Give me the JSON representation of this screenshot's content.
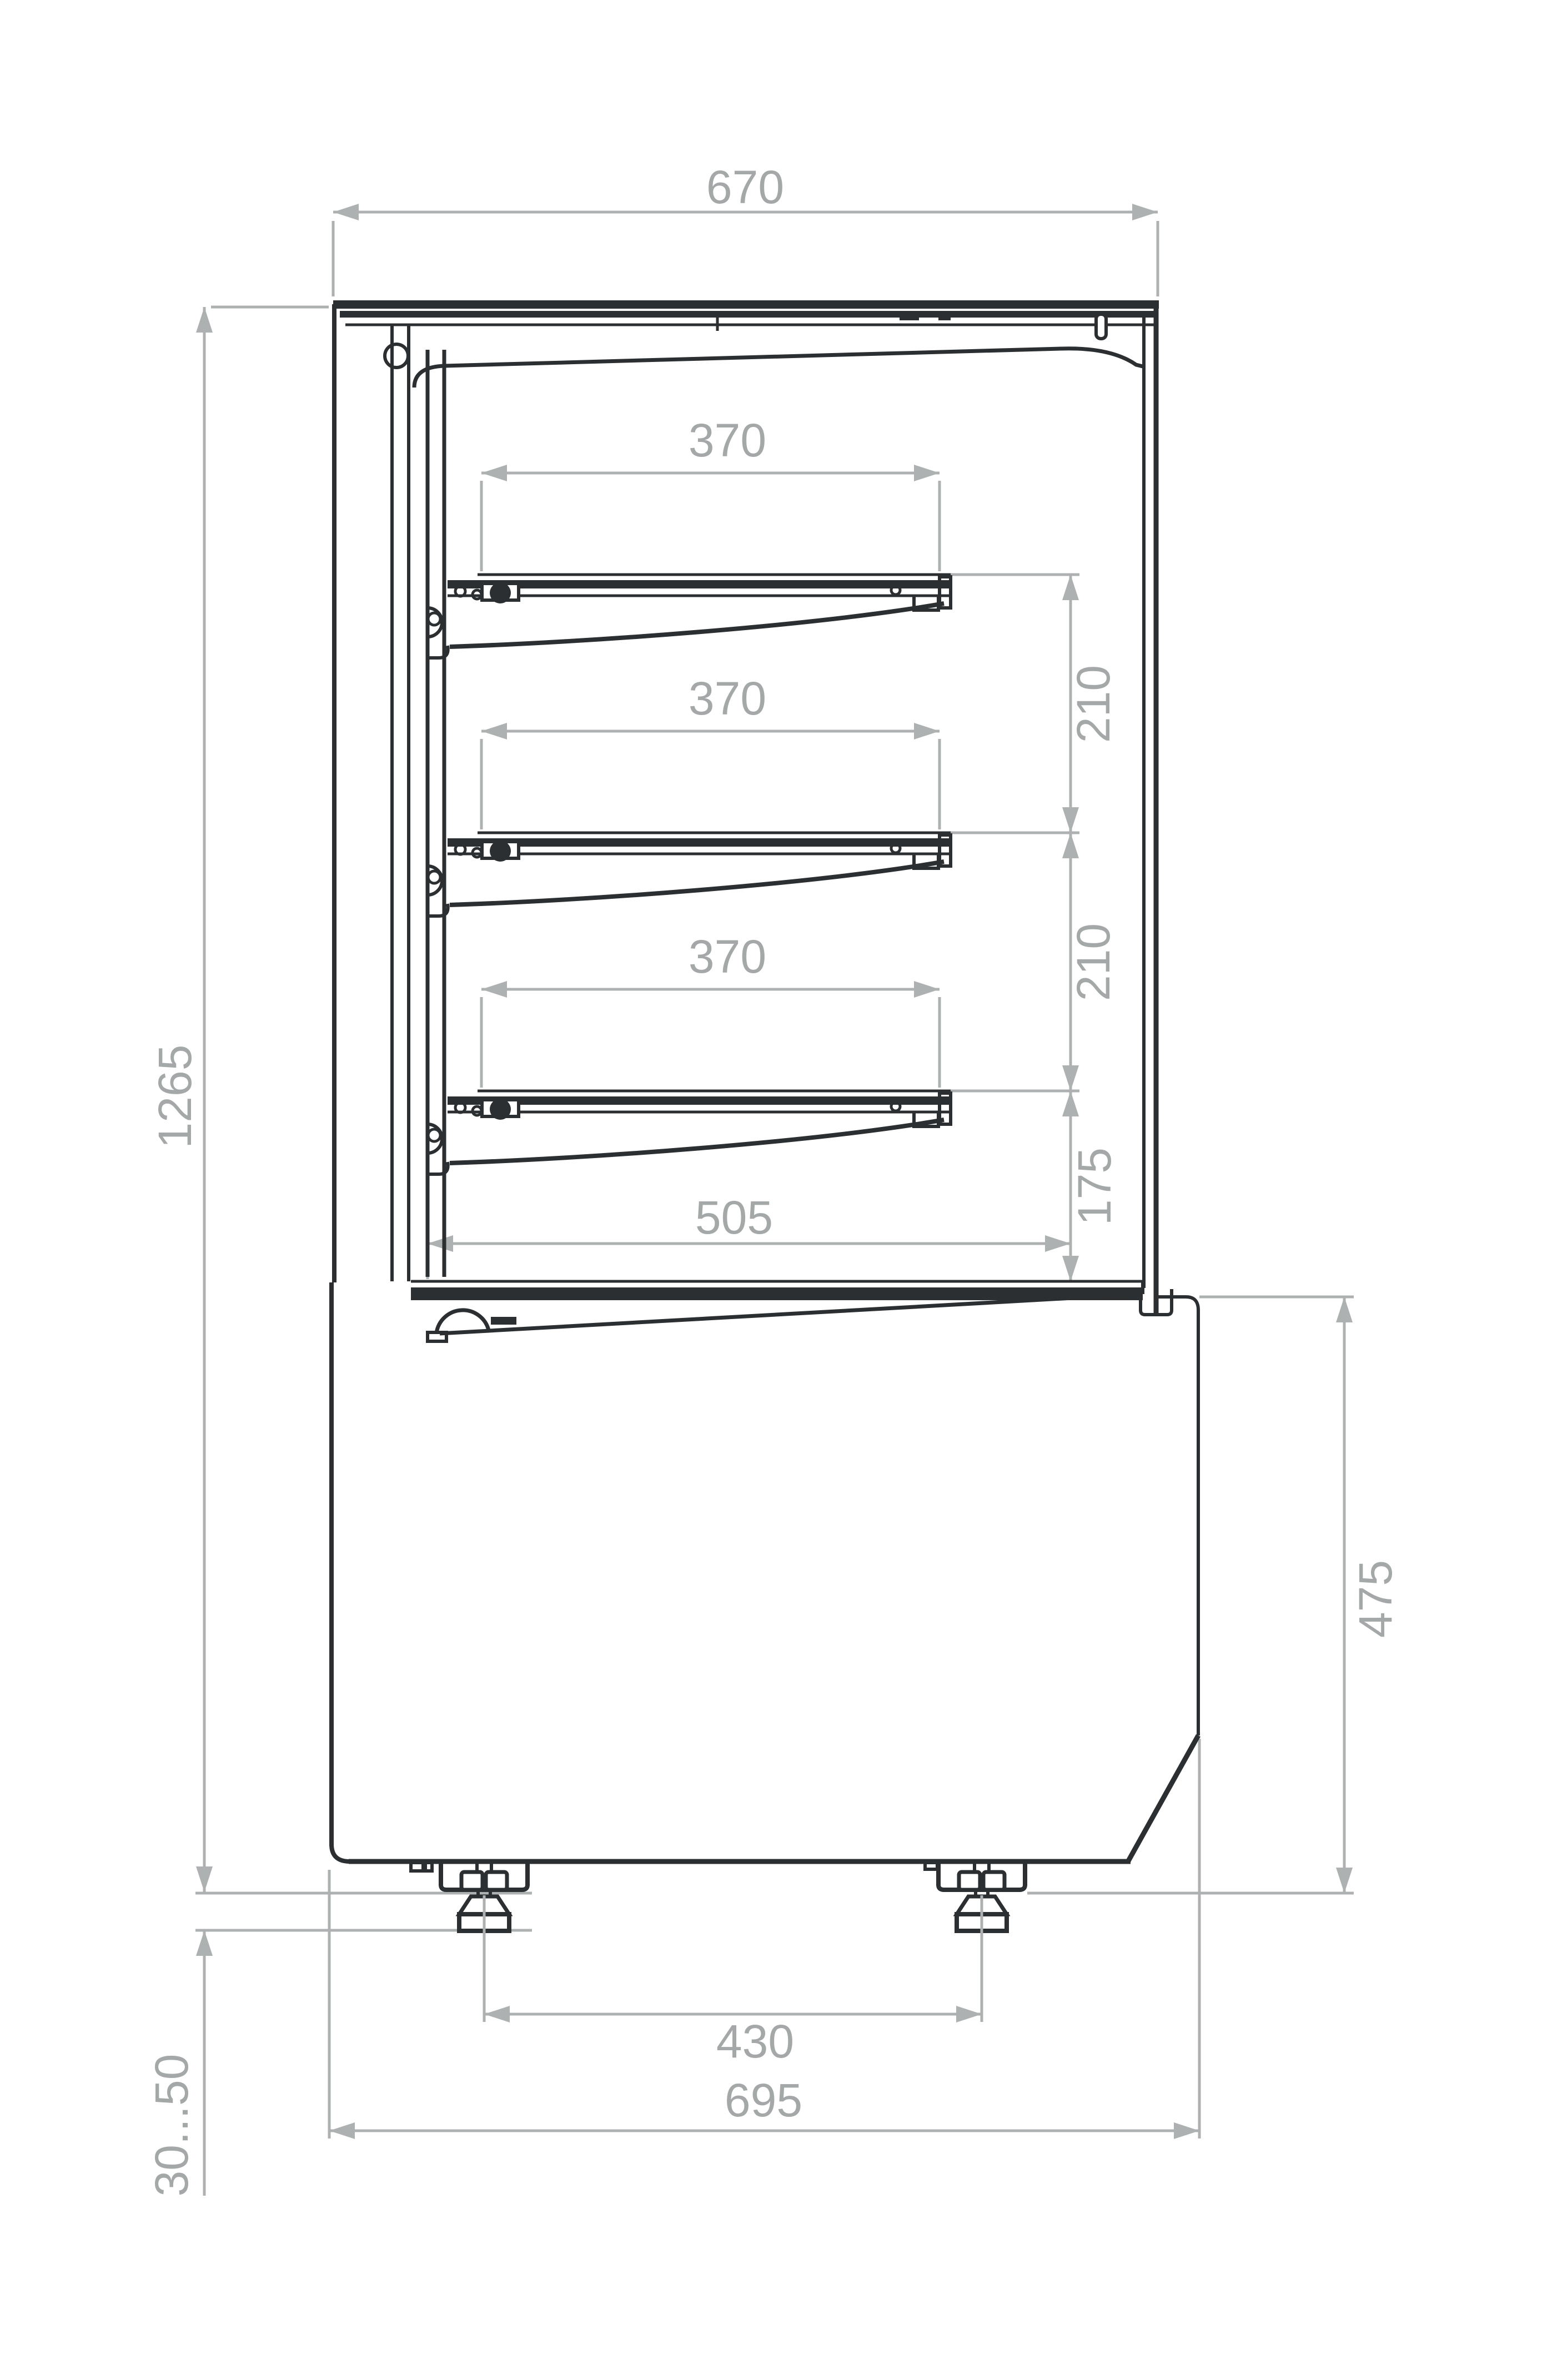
{
  "drawing": {
    "kind": "refrigerated-display-case-side-section",
    "dimensions": {
      "top_width": "670",
      "overall_height": "1265",
      "shelf1_width": "370",
      "shelf2_width": "370",
      "shelf3_width": "370",
      "shelf1_to_shelf2": "210",
      "shelf2_to_shelf3": "210",
      "shelf3_to_deck": "175",
      "deck_depth": "505",
      "base_height": "475",
      "feet_spacing": "430",
      "base_depth": "695",
      "foot_adjustment": "30...50"
    },
    "colors": {
      "background": "#ffffff",
      "outline": "#2c2f31",
      "dimension_lines": "#aeb1b1",
      "dimension_text": "#a5a8a8"
    }
  }
}
